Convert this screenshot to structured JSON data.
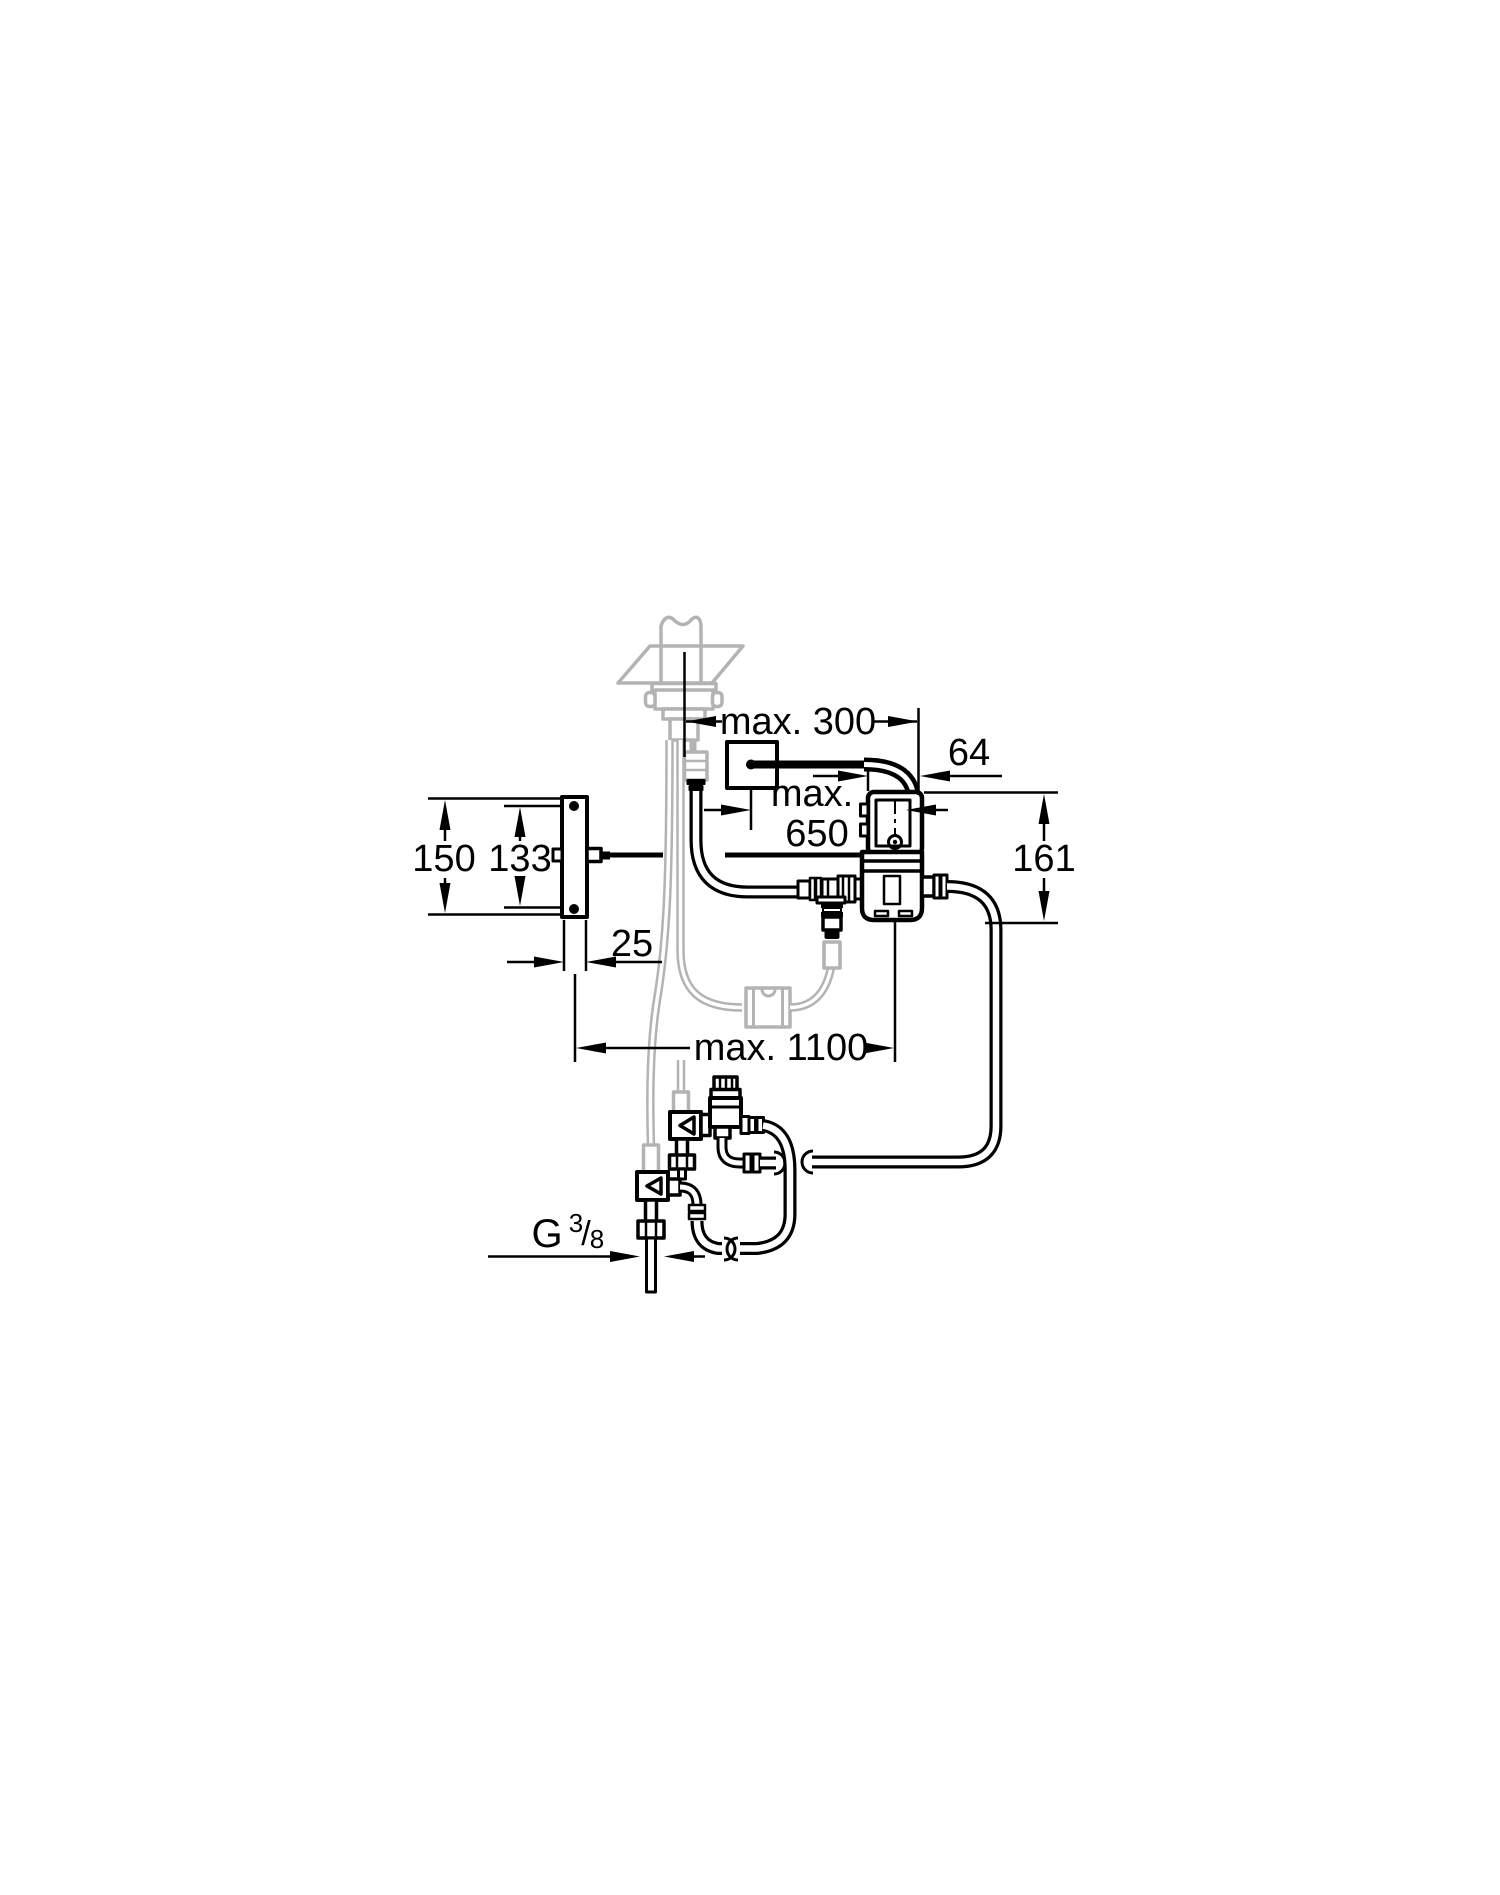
{
  "figure": {
    "type": "technical-installation-diagram",
    "colors": {
      "line": "#000000",
      "ghost": "#b3b3b3",
      "background": "#ffffff"
    },
    "labels": {
      "max300": "max. 300",
      "max650_line1": "max.",
      "max650_line2": "650",
      "offset64": "64",
      "height161": "161",
      "plate_height150": "150",
      "screw_spacing133": "133",
      "plate_depth25": "25",
      "max1100": "max. 1100",
      "thread_G": "G",
      "thread_numerator": "3",
      "thread_slash": "/",
      "thread_denominator": "8"
    }
  }
}
